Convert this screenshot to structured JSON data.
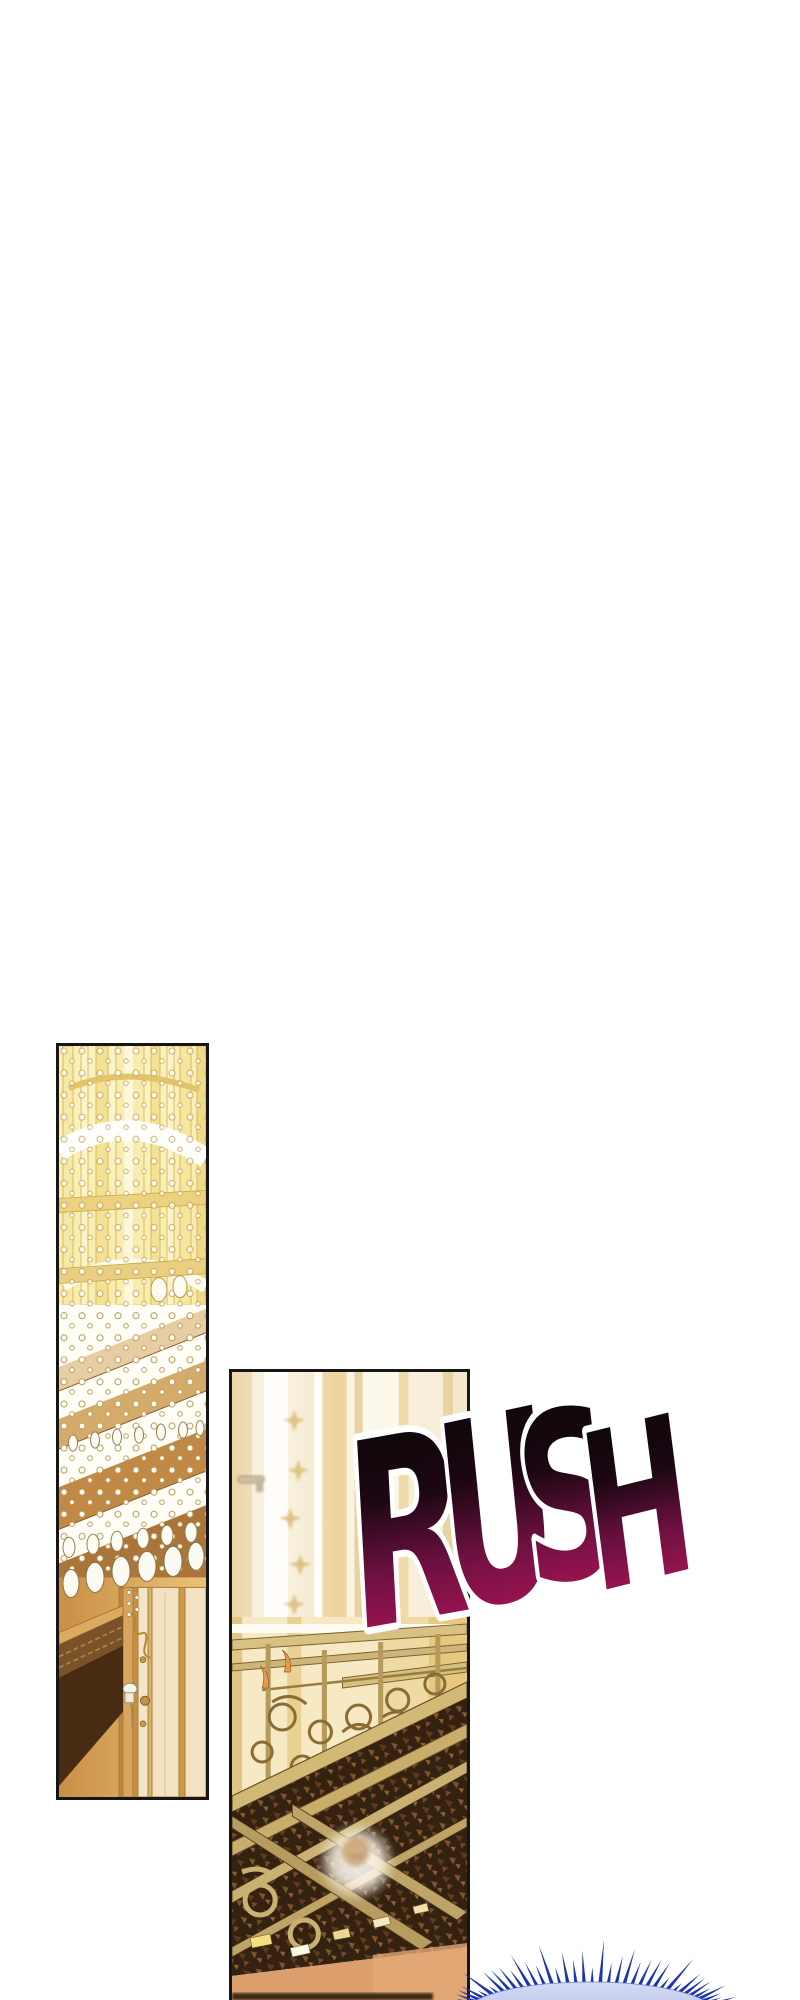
{
  "page": {
    "background_color": "#ffffff",
    "panel_border_color": "#161616"
  },
  "sfx": {
    "text": "RUSH",
    "letters": [
      "R",
      "U",
      "S",
      "H"
    ],
    "gradient_top": "#070707",
    "gradient_mid": "#6d1040",
    "gradient_bottom": "#c2175f",
    "outline_color": "#ffffff"
  },
  "panel_chandelier": {
    "glow_gold": "#f8ecae",
    "frame_gold": "#d2b148",
    "band_amber": "#d5ab6c",
    "band_brown": "#aa743a",
    "frieze_brown": "#7a5228",
    "cornice_dark": "#472c13",
    "wall_gold_left": "#c88f45",
    "wall_gold_right": "#ecc277",
    "door_cream": "#f2e2c2",
    "crystal_white": "#fcfbf3"
  },
  "panel_balcony": {
    "curtain_cream": "#f6ecd2",
    "curtain_gold": "#eccf92",
    "railing_gold": "#d2b976",
    "railing_outline": "#6b5128",
    "scroll_stroke": "#8a6c34",
    "floor_dark": "#33220f",
    "floor_orange": "#dc9e6c",
    "tile_yellow": "#f2e17e",
    "flame_orange": "#e79a4e"
  },
  "burst": {
    "spike_color": "#1e35ad",
    "dome_color": "#9dabdd",
    "dome_highlight": "#d6dcf4"
  }
}
